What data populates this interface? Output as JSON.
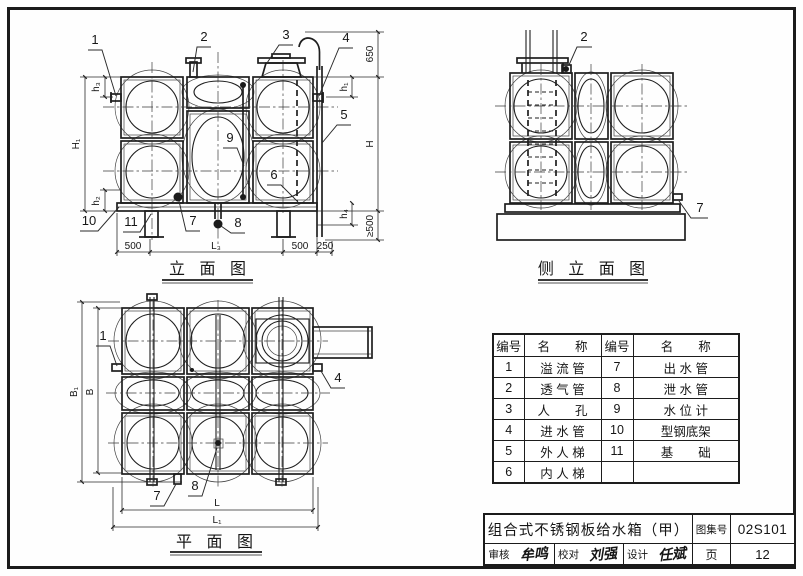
{
  "elevation": {
    "caption": "立 面 图",
    "callouts": {
      "c1": "1",
      "c2": "2",
      "c3": "3",
      "c4": "4",
      "c5": "5",
      "c6": "6",
      "c7": "7",
      "c8": "8",
      "c9": "9",
      "c10": "10",
      "c11": "11"
    },
    "dims": {
      "hook_height": "650",
      "h1": "h₁",
      "H": "H",
      "h4": "h₄",
      "min500": "≥500",
      "H1": "H₁",
      "h3": "h₃",
      "h2": "h₂",
      "left500": "500",
      "L3": "L₃",
      "right500": "500",
      "ladder250": "250"
    }
  },
  "side_view": {
    "caption": "侧 立 面 图",
    "callouts": {
      "c2": "2",
      "c7": "7"
    }
  },
  "plan": {
    "caption": "平 面 图",
    "callouts": {
      "c1": "1",
      "c4": "4",
      "c7": "7",
      "c8": "8"
    },
    "dims": {
      "B1": "B₁",
      "B": "B",
      "L": "L",
      "L1": "L₁"
    }
  },
  "parts_table": {
    "headers": [
      "编号",
      "名　　称",
      "编号",
      "名　　称"
    ],
    "rows": [
      [
        "1",
        "溢 流 管",
        "7",
        "出 水 管"
      ],
      [
        "2",
        "透 气 管",
        "8",
        "泄 水 管"
      ],
      [
        "3",
        "人　　孔",
        "9",
        "水 位 计"
      ],
      [
        "4",
        "进 水 管",
        "10",
        "型钢底架"
      ],
      [
        "5",
        "外 人 梯",
        "11",
        "基　　础"
      ],
      [
        "6",
        "内 人 梯",
        "",
        ""
      ]
    ]
  },
  "title_block": {
    "title": "组合式不锈钢板给水箱（甲）",
    "atlas_label": "图集号",
    "atlas_no": "02S101",
    "page_label": "页",
    "page_no": "12",
    "audit_label": "审核",
    "audit_sig": "牟鸣",
    "check_label": "校对",
    "check_sig": "刘强",
    "design_label": "设计",
    "design_sig": "任斌"
  }
}
